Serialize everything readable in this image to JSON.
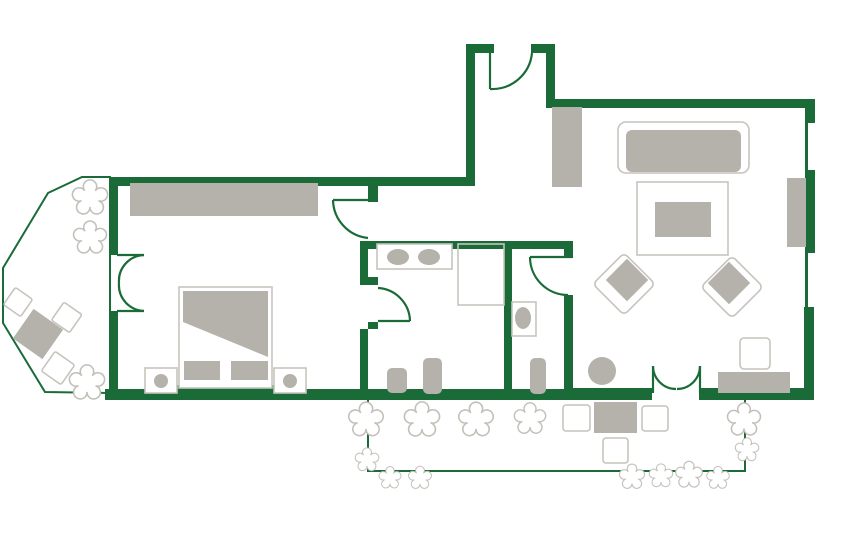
{
  "plan": {
    "type": "floor-plan",
    "subject": "hotel-suite-apartment",
    "colors": {
      "wall": "#1a6b38",
      "furn": "#b5b2ab",
      "line": "#c7c4be",
      "bush": "#c3c0ba",
      "bg": "#ffffff"
    },
    "rooms": [
      {
        "name": "entry-hall",
        "furniture": [
          "entry-door",
          "closet"
        ]
      },
      {
        "name": "bedroom",
        "furniture": [
          "wardrobe",
          "double-bed",
          "duvet",
          "pillow",
          "pillow",
          "nightstand",
          "nightstand",
          "lamp",
          "lamp",
          "balcony-french-door",
          "room-door"
        ]
      },
      {
        "name": "bathroom",
        "furniture": [
          "double-vanity",
          "sink",
          "sink",
          "shower",
          "radiator",
          "radiator",
          "door"
        ]
      },
      {
        "name": "wc",
        "furniture": [
          "toilet",
          "radiator",
          "door"
        ]
      },
      {
        "name": "living-room",
        "furniture": [
          "sofa",
          "coffee-table",
          "armchair",
          "armchair",
          "side-table",
          "desk",
          "desk-chair",
          "wall-console",
          "window",
          "window",
          "terrace-french-door"
        ]
      },
      {
        "name": "balcony",
        "furniture": [
          "chair",
          "chair",
          "chair",
          "table"
        ],
        "plants": 3
      },
      {
        "name": "terrace",
        "furniture": [
          "table",
          "table",
          "table",
          "table",
          "dining-table"
        ],
        "plants": 13
      }
    ],
    "door_count": 6,
    "window_count": 2
  }
}
